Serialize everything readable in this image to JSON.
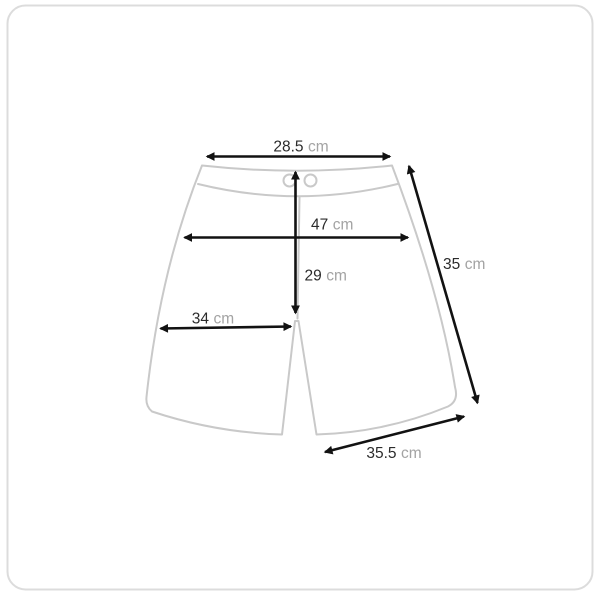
{
  "card": {
    "background_color": "#ffffff",
    "border_color": "#dcdcdc"
  },
  "diagram": {
    "outline_color": "#c9c9c9",
    "dimension_line_color": "#121212",
    "value_text_color": "#2b2b2b",
    "unit_text_color": "#a3a3a3",
    "measurements": {
      "waist_width": {
        "value": "28.5",
        "unit": "cm"
      },
      "hip_width": {
        "value": "47",
        "unit": "cm"
      },
      "rise_length": {
        "value": "29",
        "unit": "cm"
      },
      "thigh_width": {
        "value": "34",
        "unit": "cm"
      },
      "side_length": {
        "value": "35",
        "unit": "cm"
      },
      "hem_width": {
        "value": "35.5",
        "unit": "cm"
      }
    }
  }
}
